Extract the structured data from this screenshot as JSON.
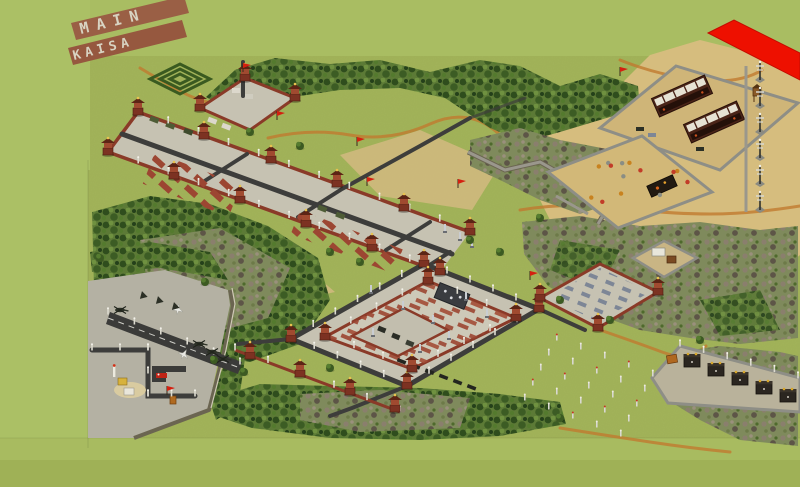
{
  "map_text": {
    "line1": "MAIN",
    "line2": "KAISA"
  },
  "colors": {
    "grass": "#a3b45a",
    "grass_smooth": "#abc065",
    "grass_dark": "#9fb156",
    "dirt_strip": "#9a5f45",
    "letter_tile": "#d8d3c2",
    "sand": "#d6bd7e",
    "pavement": "#c6c2b2",
    "road": "#3d3d3b",
    "wall_red": "#8a3a28",
    "brick": "#9c4632",
    "forest_green": "#4e7030",
    "bare_forest": "#7f8a5c",
    "stone_wall": "#9a978c",
    "marker_red": "#ee1000",
    "path_dirt": "#c07a30",
    "flag_red": "#d42010"
  },
  "features": [
    {
      "id": "player-name-ground-tiles",
      "label": "MAIN / KAISA spelled in pavement tiles on dirt strips"
    },
    {
      "id": "red-annotation-marker",
      "label": "Red parallelogram marker at top right"
    },
    {
      "id": "imperial-avenue",
      "label": "Long walled avenue with pagoda towers and crossing roads"
    },
    {
      "id": "central-palace-complex",
      "label": "Central walled palace with ring road, inner courtyard and monument"
    },
    {
      "id": "north-desert-base",
      "label": "Walled desert base with two barracks and watchtower"
    },
    {
      "id": "sandbag-compound",
      "label": "Walled sandbag yard with barrels"
    },
    {
      "id": "power-pylon-line",
      "label": "Column of power pylons on sand"
    },
    {
      "id": "forest-fort",
      "label": "Small stone fort in the forest"
    },
    {
      "id": "shrine-row-compound",
      "label": "Stone compound with a row of dark shrine gates"
    },
    {
      "id": "airfield",
      "label": "Paved airfield with runway, helicopters and service vehicles"
    },
    {
      "id": "hedge-maze",
      "label": "Square hedge maze"
    },
    {
      "id": "memorial-field",
      "label": "Rows of small posts in a field"
    }
  ]
}
